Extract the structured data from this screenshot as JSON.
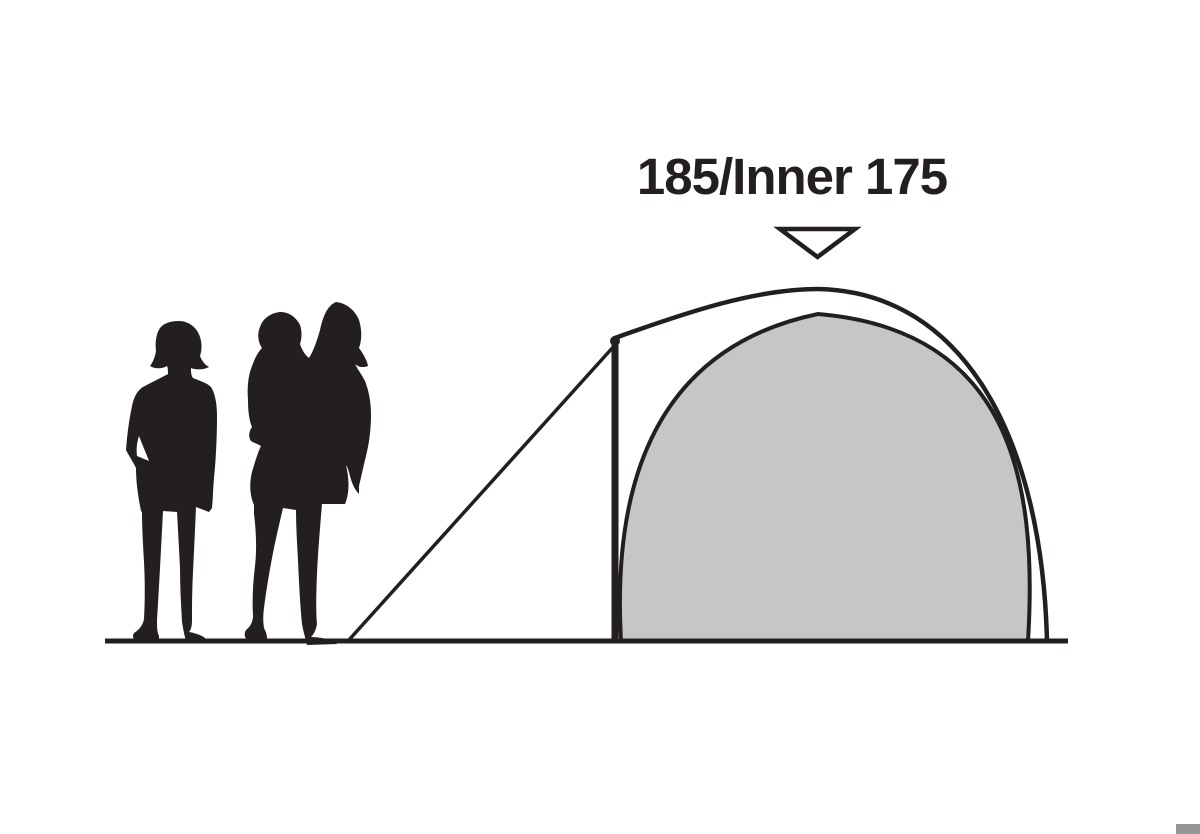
{
  "diagram": {
    "height_label": "185/Inner 175",
    "marker_icon": "down-triangle-marker",
    "scene": {
      "tent_parts": [
        "flysheet-outline",
        "inner-tent",
        "tent-pole",
        "guy-line",
        "ground-line"
      ],
      "people": [
        "adult-silhouette",
        "adult-carrying-child-silhouette"
      ]
    },
    "colors": {
      "ink": "#231f20",
      "inner_tent_fill": "#c5c6c6",
      "background": "#ffffff",
      "corner_mark": "#969696"
    }
  }
}
